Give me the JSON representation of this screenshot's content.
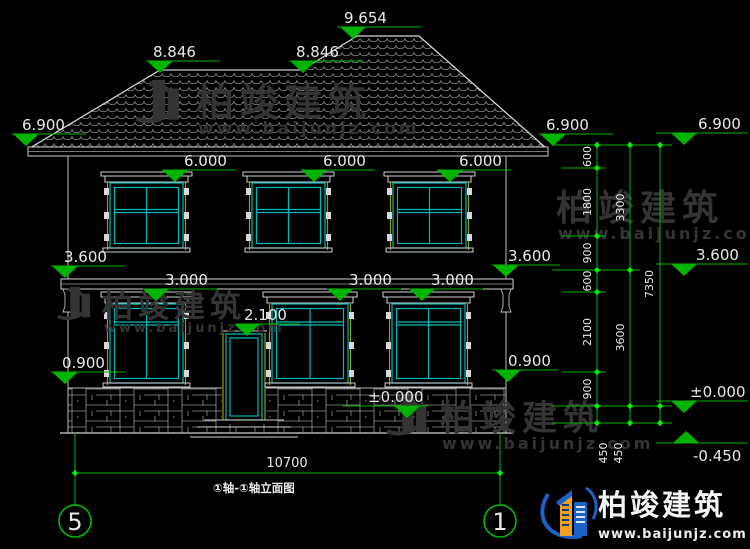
{
  "drawing": {
    "title": "①轴-①轴立面图",
    "axis_left": "5",
    "axis_right": "1"
  },
  "markers": {
    "ridge": "9.654",
    "break_left": "8.846",
    "break_right": "8.846",
    "eave_left": "6.900",
    "eave_right": "6.900",
    "eave_far": "6.900",
    "win2_1": "6.000",
    "win2_2": "6.000",
    "win2_3": "6.000",
    "floor_left": "3.600",
    "floor_right": "3.600",
    "floor_far": "3.600",
    "win1_1": "3.000",
    "win1_2": "3.000",
    "win1_3": "3.000",
    "door_top": "2.100",
    "sill_left": "0.900",
    "sill_right": "0.900",
    "ground": "±0.000",
    "ground_far": "±0.000",
    "footing": "-0.450"
  },
  "dims": {
    "v1": [
      "600",
      "1800",
      "900",
      "600",
      "2100",
      "900",
      "450"
    ],
    "v2": [
      "3300",
      "3600",
      "450"
    ],
    "total_height": "7350",
    "total_width": "10700"
  },
  "watermark": {
    "brand": "柏竣建筑",
    "site": "www.baijunjz.com"
  },
  "logo": {
    "brand": "柏竣建筑",
    "site": "www.baijunjz.com"
  },
  "colors": {
    "dimension_green": "#00b400",
    "tick_green": "#00ef00",
    "outline_white": "#d0d0d0",
    "window_cyan": "#00b8b8",
    "trim_yellow": "#9b9b00",
    "logo_blue": "#1a62c4",
    "logo_orange": "#f09f1f"
  }
}
